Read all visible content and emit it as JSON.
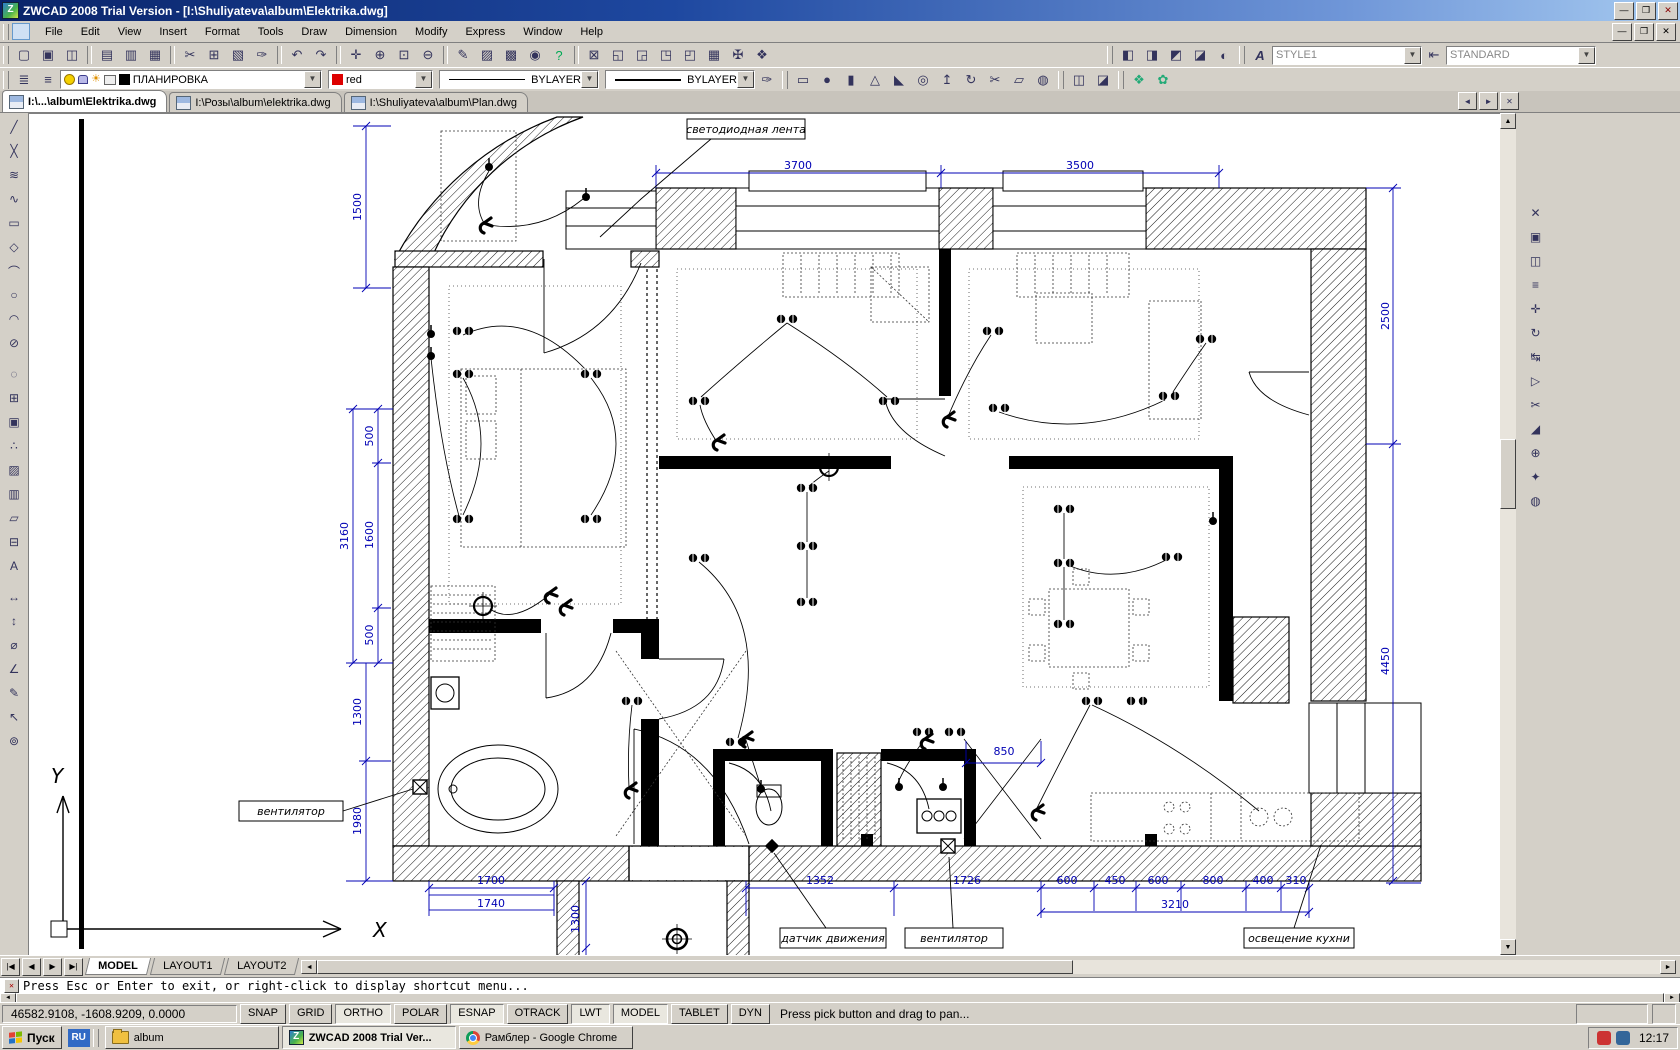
{
  "window": {
    "title": "ZWCAD 2008 Trial Version - [I:\\Shuliyateva\\album\\Elektrika.dwg]"
  },
  "menu": [
    "File",
    "Edit",
    "View",
    "Insert",
    "Format",
    "Tools",
    "Draw",
    "Dimension",
    "Modify",
    "Express",
    "Window",
    "Help"
  ],
  "toolbars": {
    "text_style": "STYLE1",
    "dim_style": "STANDARD",
    "layer": "ПЛАНИРОВКА",
    "color": "red",
    "linetype": "BYLAYER",
    "lineweight": "BYLAYER"
  },
  "doc_tabs": [
    "I:\\...\\album\\Elektrika.dwg",
    "I:\\Розы\\album\\elektrika.dwg",
    "I:\\Shuliyateva\\album\\Plan.dwg"
  ],
  "plan": {
    "callouts": {
      "led": "светодиодная лента",
      "fan_left": "вентилятор",
      "motion": "датчик движения",
      "fan_bottom": "вентилятор",
      "kitchen": "освещение кухни"
    },
    "dims": {
      "top_left": "3700",
      "top_right": "3500",
      "right_upper": "2500",
      "right_lower": "4450",
      "l1500": "1500",
      "l500a": "500",
      "l3160": "3160",
      "l1600": "1600",
      "l500b": "500",
      "l1300": "1300",
      "l1980": "1980",
      "b1700": "1700",
      "b1740": "1740",
      "b1352": "1352",
      "b1726": "1726",
      "b600a": "600",
      "b450": "450",
      "b600b": "600",
      "b800": "800",
      "b400": "400",
      "b310": "310",
      "b3210": "3210",
      "m850": "850",
      "v1300": "1300"
    },
    "ucs": {
      "x": "X",
      "y": "Y"
    }
  },
  "layout_tabs": [
    "MODEL",
    "LAYOUT1",
    "LAYOUT2"
  ],
  "command_line": "Press Esc or Enter to exit, or right-click to display shortcut menu...",
  "statusbar": {
    "coords": "46582.9108,  -1608.9209,  0.0000",
    "buttons": [
      "SNAP",
      "GRID",
      "ORTHO",
      "POLAR",
      "ESNAP",
      "OTRACK",
      "LWT",
      "MODEL",
      "TABLET",
      "DYN"
    ],
    "hint": "Press pick button and drag to pan..."
  },
  "taskbar": {
    "start": "Пуск",
    "lang": "RU",
    "task_album": "album",
    "task_zwcad": "ZWCAD 2008 Trial Ver...",
    "task_chrome": "Рамблер - Google Chrome",
    "clock": "12:17"
  },
  "icons": {
    "std": [
      "▢",
      "▣",
      "◫",
      "▤",
      "▥",
      "▦",
      "✂",
      "⊞",
      "▧",
      "✑",
      "↶",
      "↷",
      "✛",
      "⊕",
      "⊡",
      "⊖",
      "✎",
      "▨",
      "▩",
      "◉",
      "?"
    ],
    "extra": [
      "⊠",
      "◱",
      "◲",
      "◳",
      "◰",
      "▦",
      "✠",
      "❖"
    ],
    "three_d": [
      "◧",
      "◨",
      "◩",
      "◪",
      "◐"
    ],
    "layer_tools": [
      "≣",
      "≡"
    ],
    "solids": [
      "▭",
      "●",
      "▮",
      "△",
      "◣",
      "◎",
      "↥",
      "↻",
      "✂",
      "▱",
      "◍"
    ],
    "booleans": [
      "◫",
      "◪"
    ],
    "render": [
      "❖",
      "✿"
    ],
    "left_strip": [
      "╱",
      "╳",
      "≋",
      "∿",
      "▭",
      "◇",
      "⌒",
      "○",
      "◠",
      "⊘",
      "◌",
      "⊞",
      "▣",
      "∴",
      "▨",
      "▥",
      "▱",
      "⊟",
      "A",
      "↔",
      "↕",
      "⌀",
      "∠",
      "✎",
      "↖",
      "⊚"
    ],
    "right_strip": [
      "✕",
      "▣",
      "◫",
      "≡",
      "✛",
      "↻",
      "↹",
      "▷",
      "✂",
      "◢",
      "⊕",
      "✦",
      "◍"
    ],
    "nav": {
      "first": "|◀",
      "prev": "◀",
      "next": "▶",
      "last": "▶|"
    },
    "tab_ctrl": {
      "left": "◄",
      "right": "►",
      "close": "✕"
    },
    "scroll": {
      "up": "▲",
      "down": "▼",
      "left": "◄",
      "right": "►"
    },
    "win": {
      "min": "—",
      "max": "❒",
      "close": "✕"
    },
    "cmd_icon": "✕"
  }
}
